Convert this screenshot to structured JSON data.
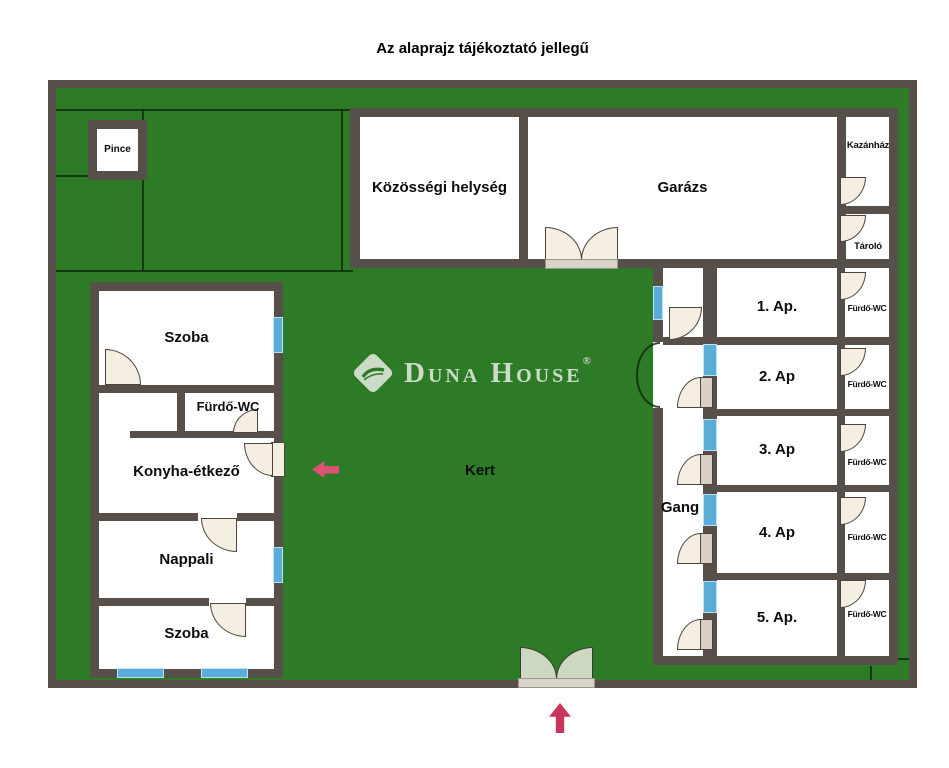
{
  "title": "Az alaprajz tájékoztató jellegű",
  "watermark": {
    "word1": "Duna",
    "word2": "House",
    "registered": "®"
  },
  "labels": {
    "pince": "Pince",
    "kozossegi": "Közösségi helység",
    "garazs": "Garázs",
    "kazanhaz": "Kazánház",
    "tarolo": "Tároló",
    "szoba_felso": "Szoba",
    "furdo_wc": "Fürdő-WC",
    "konyha": "Konyha-étkező",
    "nappali": "Nappali",
    "szoba_also": "Szoba",
    "kert": "Kert",
    "gang": "Gang"
  },
  "apartments": [
    {
      "name": "1. Ap.",
      "bath": "Fürdő-WC"
    },
    {
      "name": "2. Ap",
      "bath": "Fürdő-WC"
    },
    {
      "name": "3. Ap",
      "bath": "Fürdő-WC"
    },
    {
      "name": "4. Ap",
      "bath": "Fürdő-WC"
    },
    {
      "name": "5. Ap.",
      "bath": "Fürdő-WC"
    }
  ],
  "colors": {
    "garden_green": "#2d7a27",
    "wall_brown": "#57504a",
    "window_blue": "#5badd9",
    "door_cream": "#f5eee3",
    "gate_green": "#ccd8bf",
    "arrow_red": "#c6355a"
  }
}
